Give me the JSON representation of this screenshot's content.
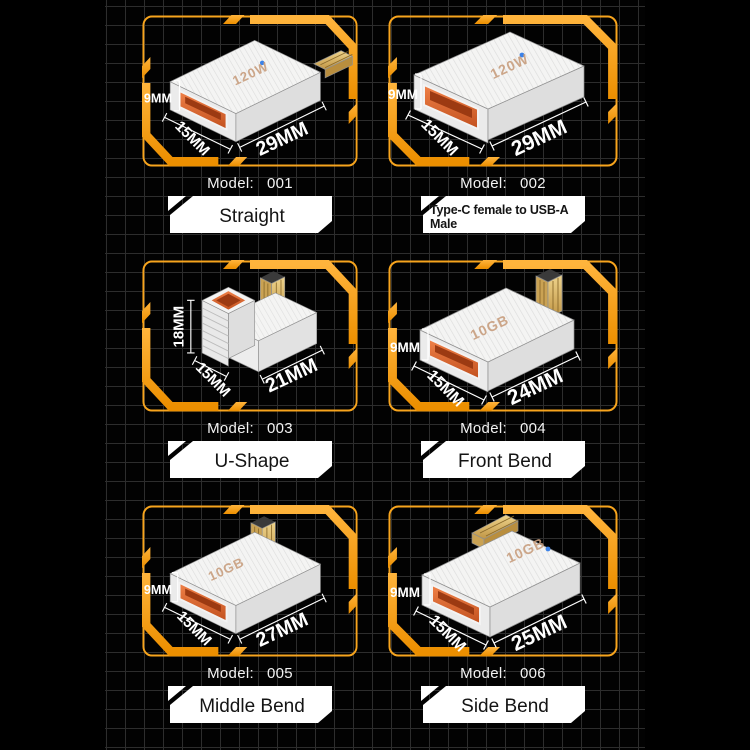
{
  "canvas": {
    "background": "#000000",
    "grid_line_color": "#2d2d2d",
    "accent_orange": "#F7A41D",
    "port_orange": "#D95A28",
    "connector_gold": "#D9B877",
    "badge_background": "#FFFFFF",
    "badge_text_color": "#141414",
    "dimension_text_color": "#FFFFFF"
  },
  "cells": [
    {
      "model_label": "Model:",
      "model_number": "001",
      "name": "Straight",
      "dim_height": "9MM",
      "dim_width": "15MM",
      "dim_length": "29MM",
      "body_text": "120W"
    },
    {
      "model_label": "Model:",
      "model_number": "002",
      "name": "Type-C female to USB-A Male",
      "dim_height": "9MM",
      "dim_width": "15MM",
      "dim_length": "29MM",
      "body_text": "120W"
    },
    {
      "model_label": "Model:",
      "model_number": "003",
      "name": "U-Shape",
      "dim_height": "18MM",
      "dim_width": "15MM",
      "dim_length": "21MM",
      "body_text": ""
    },
    {
      "model_label": "Model:",
      "model_number": "004",
      "name": "Front Bend",
      "dim_height": "9MM",
      "dim_width": "15MM",
      "dim_length": "24MM",
      "body_text": "10GB"
    },
    {
      "model_label": "Model:",
      "model_number": "005",
      "name": "Middle Bend",
      "dim_height": "9MM",
      "dim_width": "15MM",
      "dim_length": "27MM",
      "body_text": "10GB"
    },
    {
      "model_label": "Model:",
      "model_number": "006",
      "name": "Side Bend",
      "dim_height": "9MM",
      "dim_width": "15MM",
      "dim_length": "25MM",
      "body_text": "10GB"
    }
  ]
}
